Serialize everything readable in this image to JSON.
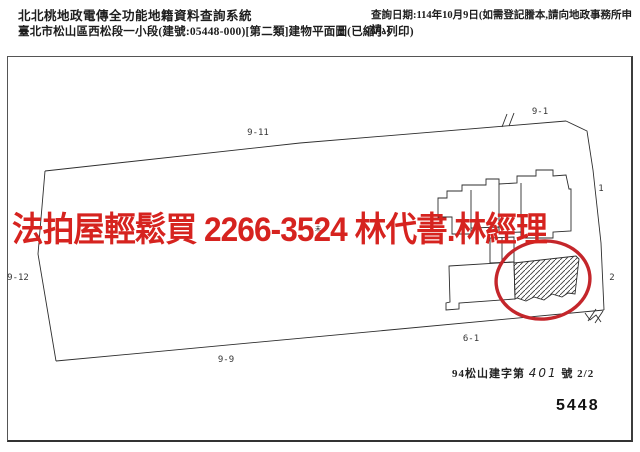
{
  "header": {
    "system_title": "北北桃地政電傳全功能地籍資料查詢系統",
    "document_title": "臺北市松山區西松段一小段(建號:05448-000)[第二類]建物平面圖(已縮小列印)",
    "query_date": "查詢日期:114年10月9日(如需登記謄本,請向地政事務所申請。)"
  },
  "overlay": {
    "ad_text": "法拍屋輕鬆買  2266-3524  林代書.林經理",
    "color": "#d6231f"
  },
  "map": {
    "labels": [
      {
        "id": "9-11",
        "text": "9-11"
      },
      {
        "id": "9-1",
        "text": "9-1"
      },
      {
        "id": "9-12",
        "text": "9-12"
      },
      {
        "id": "9-9",
        "text": "9-9"
      },
      {
        "id": "6-1",
        "text": "6-1"
      },
      {
        "id": "1",
        "text": "1"
      },
      {
        "id": "2",
        "text": "2"
      }
    ],
    "tiny_mark": {
      "top": "未",
      "bottom": "6"
    },
    "colors": {
      "circle_red": "#c4262b",
      "line_black": "#2e2e2e"
    }
  },
  "footer": {
    "permit_prefix": "94松山建字第",
    "permit_number": "401",
    "permit_suffix": "號 2/2",
    "sheet_number": "5448"
  }
}
